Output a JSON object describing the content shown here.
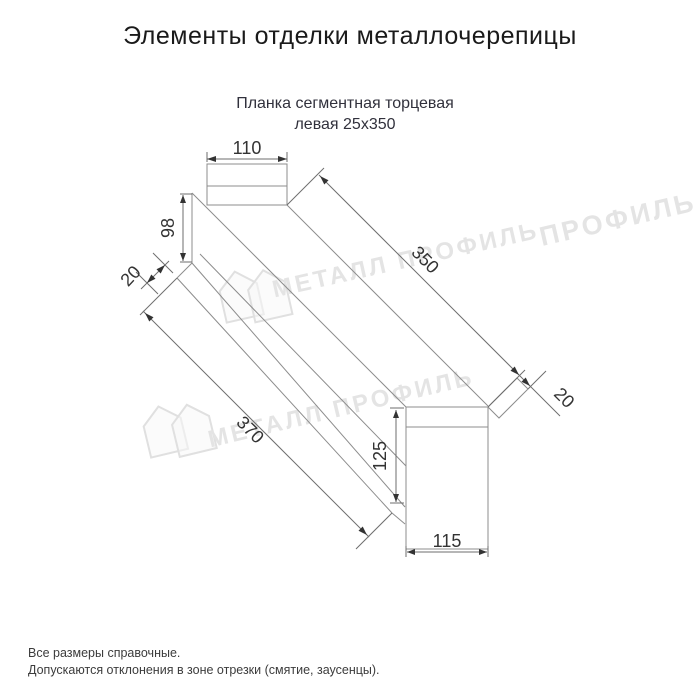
{
  "page": {
    "title": "Элементы отделки металлочерепицы",
    "subtitle_line1": "Планка сегментная торцевая",
    "subtitle_line2": "левая 25x350",
    "footer_line1": "Все размеры справочные.",
    "footer_line2": "Допускаются отклонения в зоне отрезки (смятие, заусенцы)."
  },
  "diagram": {
    "product": "Планка сегментная торцевая левая 25x350",
    "dims": {
      "top_width": "110",
      "side_height": "98",
      "side_fold": "20",
      "edge_length_right": "350",
      "end_fold": "20",
      "end_height": "125",
      "end_width": "115",
      "edge_length_left": "370"
    }
  },
  "watermarks": [
    {
      "text": "МЕТАЛЛ ПРОФИЛЬ"
    },
    {
      "text": "МЕТАЛЛ ПРОФИЛЬ"
    },
    {
      "text": "ПРОФИЛЬ"
    }
  ],
  "colors": {
    "line": "#8c8c8c",
    "dim_text": "#333333",
    "title_text": "#1a1a1a",
    "subtitle_text": "#31313c",
    "watermark": "#e4e4e4",
    "background": "#ffffff"
  }
}
